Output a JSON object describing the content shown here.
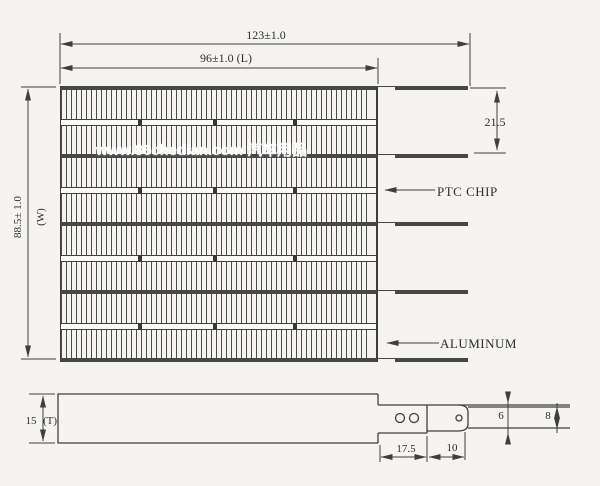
{
  "top_view": {
    "dims": {
      "overall_length": "123±1.0",
      "heater_length": "96±1.0 (L)",
      "tab_pitch": "21.5",
      "width": "88.5± 1.0",
      "width_suffix": "(W)"
    },
    "labels": {
      "ptc_chip": "PTC CHIP",
      "aluminum": "ALUMINUM"
    },
    "stack": [
      "tube",
      "fin",
      "ptc",
      "fin",
      "tube",
      "fin",
      "ptc",
      "fin",
      "tube",
      "fin",
      "ptc",
      "fin",
      "tube",
      "fin",
      "ptc",
      "fin",
      "tube"
    ],
    "ptc_separators_x": [
      77,
      152,
      232
    ],
    "tab_count": 5
  },
  "side_view": {
    "dims": {
      "thickness": "15",
      "thickness_suffix": "(T)",
      "tube_stickout": "17.5",
      "insulator_length": "10",
      "terminal_height": "6",
      "tube_height": "8"
    }
  },
  "watermark": "www.86chedian.com 汽车用品",
  "colors": {
    "background": "#f5f4f1",
    "line": "#3f3f3f",
    "tab": "#474747",
    "watermark": "#ffffff"
  }
}
